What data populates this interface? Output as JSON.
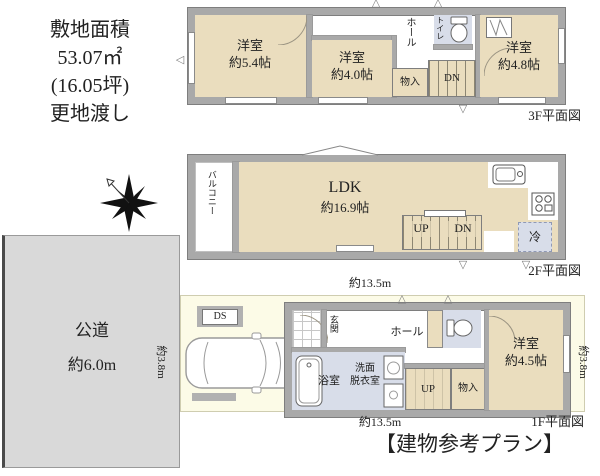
{
  "colors": {
    "room_tan": "#EADDBE",
    "wet_blue": "#D8DDE9",
    "wall_gray": "#A9A9A9",
    "road_gray": "#D9D9D9",
    "site_yellow": "#FCFBE7"
  },
  "icons": {
    "triangle_up": "△",
    "triangle_down": "▽",
    "triangle_left": "◁"
  },
  "site_info": {
    "line1": "敷地面積",
    "line2": "53.07㎡",
    "line3": "(16.05坪)",
    "line4": "更地渡し"
  },
  "road": {
    "name": "公道",
    "width": "約6.0m"
  },
  "dimensions": {
    "width_top": "約13.5m",
    "width_bottom": "約13.5m",
    "depth_left": "約3.8m",
    "depth_right": "約3.8m"
  },
  "floor3": {
    "caption": "3F平面図",
    "room_a_name": "洋室",
    "room_a_size": "約5.4帖",
    "room_b_name": "洋室",
    "room_b_size": "約4.0帖",
    "room_c_name": "洋室",
    "room_c_size": "約4.8帖",
    "hall": "ホール",
    "toilet": "トイレ",
    "storage": "物入",
    "stairs": "DN"
  },
  "floor2": {
    "caption": "2F平面図",
    "ldk_name": "LDK",
    "ldk_size": "約16.9帖",
    "balcony": "バルコニー",
    "fridge": "冷",
    "stairs_up": "UP",
    "stairs_down": "DN"
  },
  "floor1": {
    "caption": "1F平面図",
    "entrance": "玄関",
    "hall": "ホール",
    "bathroom": "浴室",
    "washroom_line1": "洗面",
    "washroom_line2": "脱衣室",
    "storage": "物入",
    "stairs_up": "UP",
    "room_name": "洋室",
    "room_size": "約4.5帖",
    "duct": "DS"
  },
  "footer": {
    "title": "【建物参考プラン】"
  }
}
